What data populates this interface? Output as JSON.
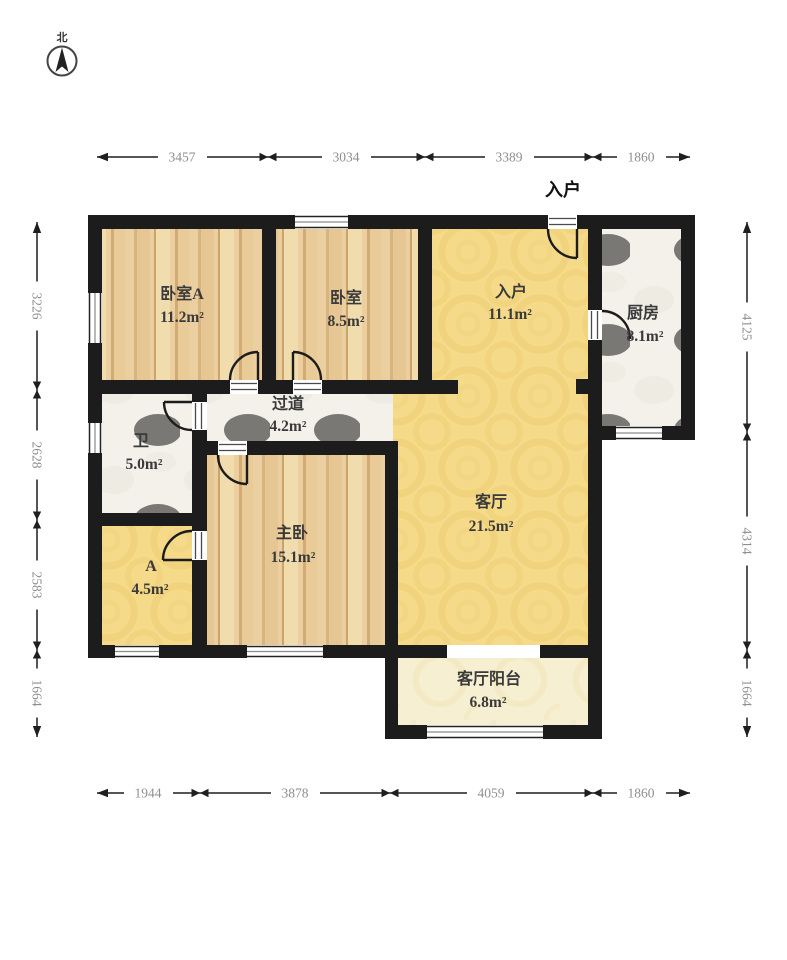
{
  "compass": {
    "north_label": "北"
  },
  "entry_marker": "入户",
  "rooms": [
    {
      "name": "卧室A",
      "area": "11.2m²",
      "floor": "wood"
    },
    {
      "name": "卧室",
      "area": "8.5m²",
      "floor": "wood"
    },
    {
      "name": "入户",
      "area": "11.1m²",
      "floor": "gold"
    },
    {
      "name": "厨房",
      "area": "8.1m²",
      "floor": "tile"
    },
    {
      "name": "过道",
      "area": "4.2m²",
      "floor": "tile"
    },
    {
      "name": "卫",
      "area": "5.0m²",
      "floor": "tile"
    },
    {
      "name": "主卧",
      "area": "15.1m²",
      "floor": "wood"
    },
    {
      "name": "A",
      "area": "4.5m²",
      "floor": "gold"
    },
    {
      "name": "客厅",
      "area": "21.5m²",
      "floor": "gold"
    },
    {
      "name": "客厅阳台",
      "area": "6.8m²",
      "floor": "cream"
    }
  ],
  "dimensions": {
    "top": [
      "3457",
      "3034",
      "3389",
      "1860"
    ],
    "bottom": [
      "1944",
      "3878",
      "4059",
      "1860"
    ],
    "left": [
      "3226",
      "2628",
      "2583",
      "1664"
    ],
    "right": [
      "4125",
      "4314",
      "1664"
    ]
  },
  "colors": {
    "wall": "#1c1c1c",
    "wood_floor": "#eccfa0",
    "gold_floor": "#f5da89",
    "tile_floor": "#f3f1ea",
    "balcony_floor": "#f7efd1",
    "dimension_text": "#8e8e8e",
    "dimension_line": "#1f1f1f"
  }
}
